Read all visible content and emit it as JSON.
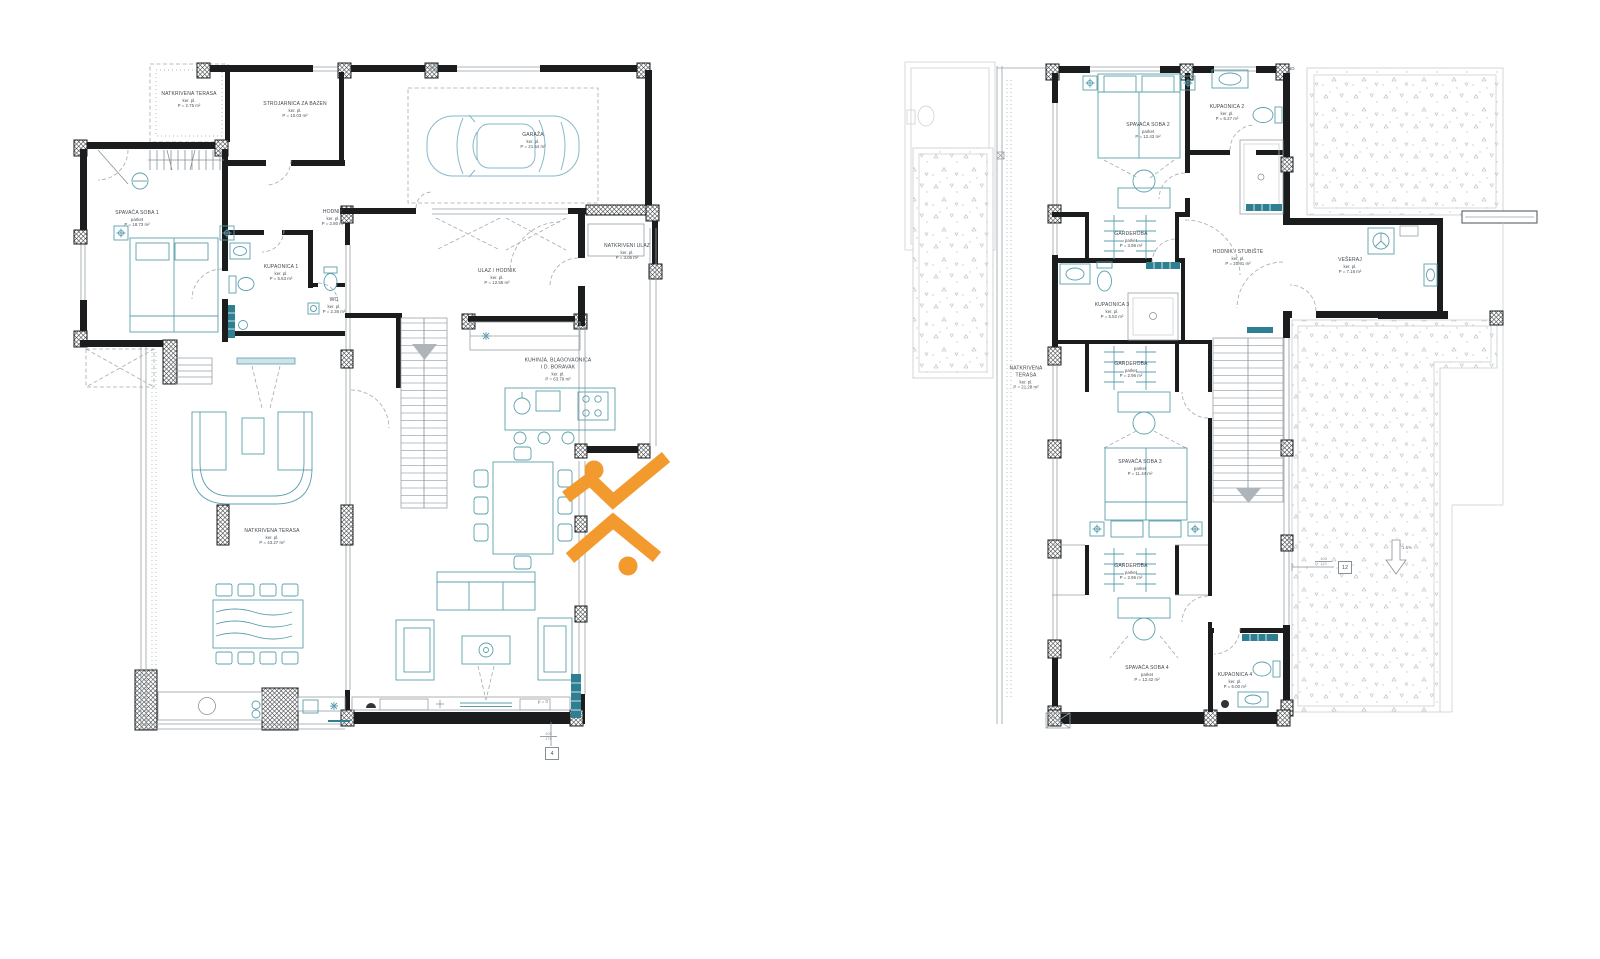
{
  "colors": {
    "wall": "#1a1c1d",
    "furniture": "#5b9fae",
    "furniture_dark": "#2f7f93",
    "car_outline": "#86b9cb",
    "logo_orange": "#F39A2E",
    "label_text": "#41484d",
    "thin_lines": "#98a0a5"
  },
  "plans": {
    "ground": {
      "title": "ground-floor-plan",
      "rooms": [
        {
          "name": "NATKRIVENA TERASA",
          "finish": "ker. pl.",
          "area": "P = 2.75 m²"
        },
        {
          "name": "STROJARNICA ZA BAZEN",
          "finish": "ker. pl.",
          "area": "P = 10.03 m²"
        },
        {
          "name": "GARAŽA",
          "finish": "ker. pl.",
          "area": "P = 21.54 m²"
        },
        {
          "name": "SPAVAĆA SOBA 1",
          "finish": "parket",
          "area": "P = 18.73 m²"
        },
        {
          "name": "HODNIK",
          "finish": "ker. pl.",
          "area": "P = 2.80 m²"
        },
        {
          "name": "KUPAONICA 1",
          "finish": "ker. pl.",
          "area": "P = 5.53 m²"
        },
        {
          "name": "WC",
          "finish": "ker. pl.",
          "area": "P = 2.36 m²"
        },
        {
          "name": "NATKRIVENI ULAZ",
          "finish": "ker. pl.",
          "area": "P = 3.06 m²"
        },
        {
          "name": "ULAZ / HODNIK",
          "finish": "ker. pl.",
          "area": "P = 12.55 m²"
        },
        {
          "name": "KUHINJA, BLAGOVAONICA",
          "name2": "I D. BORAVAK",
          "finish": "ker. pl.",
          "area": "P = 63.79 m²"
        },
        {
          "name": "NATKRIVENA TERASA",
          "finish": "ker. pl.",
          "area": "P = 43.27 m²"
        }
      ],
      "markers": {
        "level": "p = 0",
        "dim_top": "105",
        "dim_bottom": "170",
        "tag": "4"
      }
    },
    "upper": {
      "title": "first-floor-plan",
      "rooms": [
        {
          "name": "SPAVAĆA SOBA 2",
          "finish": "parket",
          "area": "P = 12.43 m²"
        },
        {
          "name": "KUPAONICA 2",
          "finish": "ker. pl.",
          "area": "P = 6.27 m²"
        },
        {
          "name": "GARDEROBA",
          "finish": "parket",
          "area": "P = 3.96 m²"
        },
        {
          "name": "HODNIK / STUBIŠTE",
          "finish": "ker. pl.",
          "area": "P = 20.91 m²"
        },
        {
          "name": "VEŠERAJ",
          "finish": "ker. pl.",
          "area": "P = 7.16 m²"
        },
        {
          "name": "KUPAONICA 3",
          "finish": "ker. pl.",
          "area": "P = 5.52 m²"
        },
        {
          "name": "NATKRIVENA",
          "name2": "TERASA",
          "finish": "ker. pl.",
          "area": "P = 21.28 m²"
        },
        {
          "name": "GARDEROBA",
          "finish": "parket",
          "area": "P = 2.96 m²"
        },
        {
          "name": "SPAVAĆA SOBA 3",
          "finish": "parket",
          "area": "P = 11.44 m²"
        },
        {
          "name": "GARDEROBA",
          "finish": "parket",
          "area": "P = 2.96 m²"
        },
        {
          "name": "SPAVAĆA SOBA 4",
          "finish": "parket",
          "area": "P = 12.42 m²"
        },
        {
          "name": "KUPAONICA 4",
          "finish": "ker. pl.",
          "area": "P = 6.00 m²"
        }
      ],
      "markers": {
        "slope": "1.5%",
        "dim_top": "105",
        "dim_bottom": "170",
        "tag": "12",
        "corner": "NO",
        "parapet": "p = 45"
      }
    }
  }
}
